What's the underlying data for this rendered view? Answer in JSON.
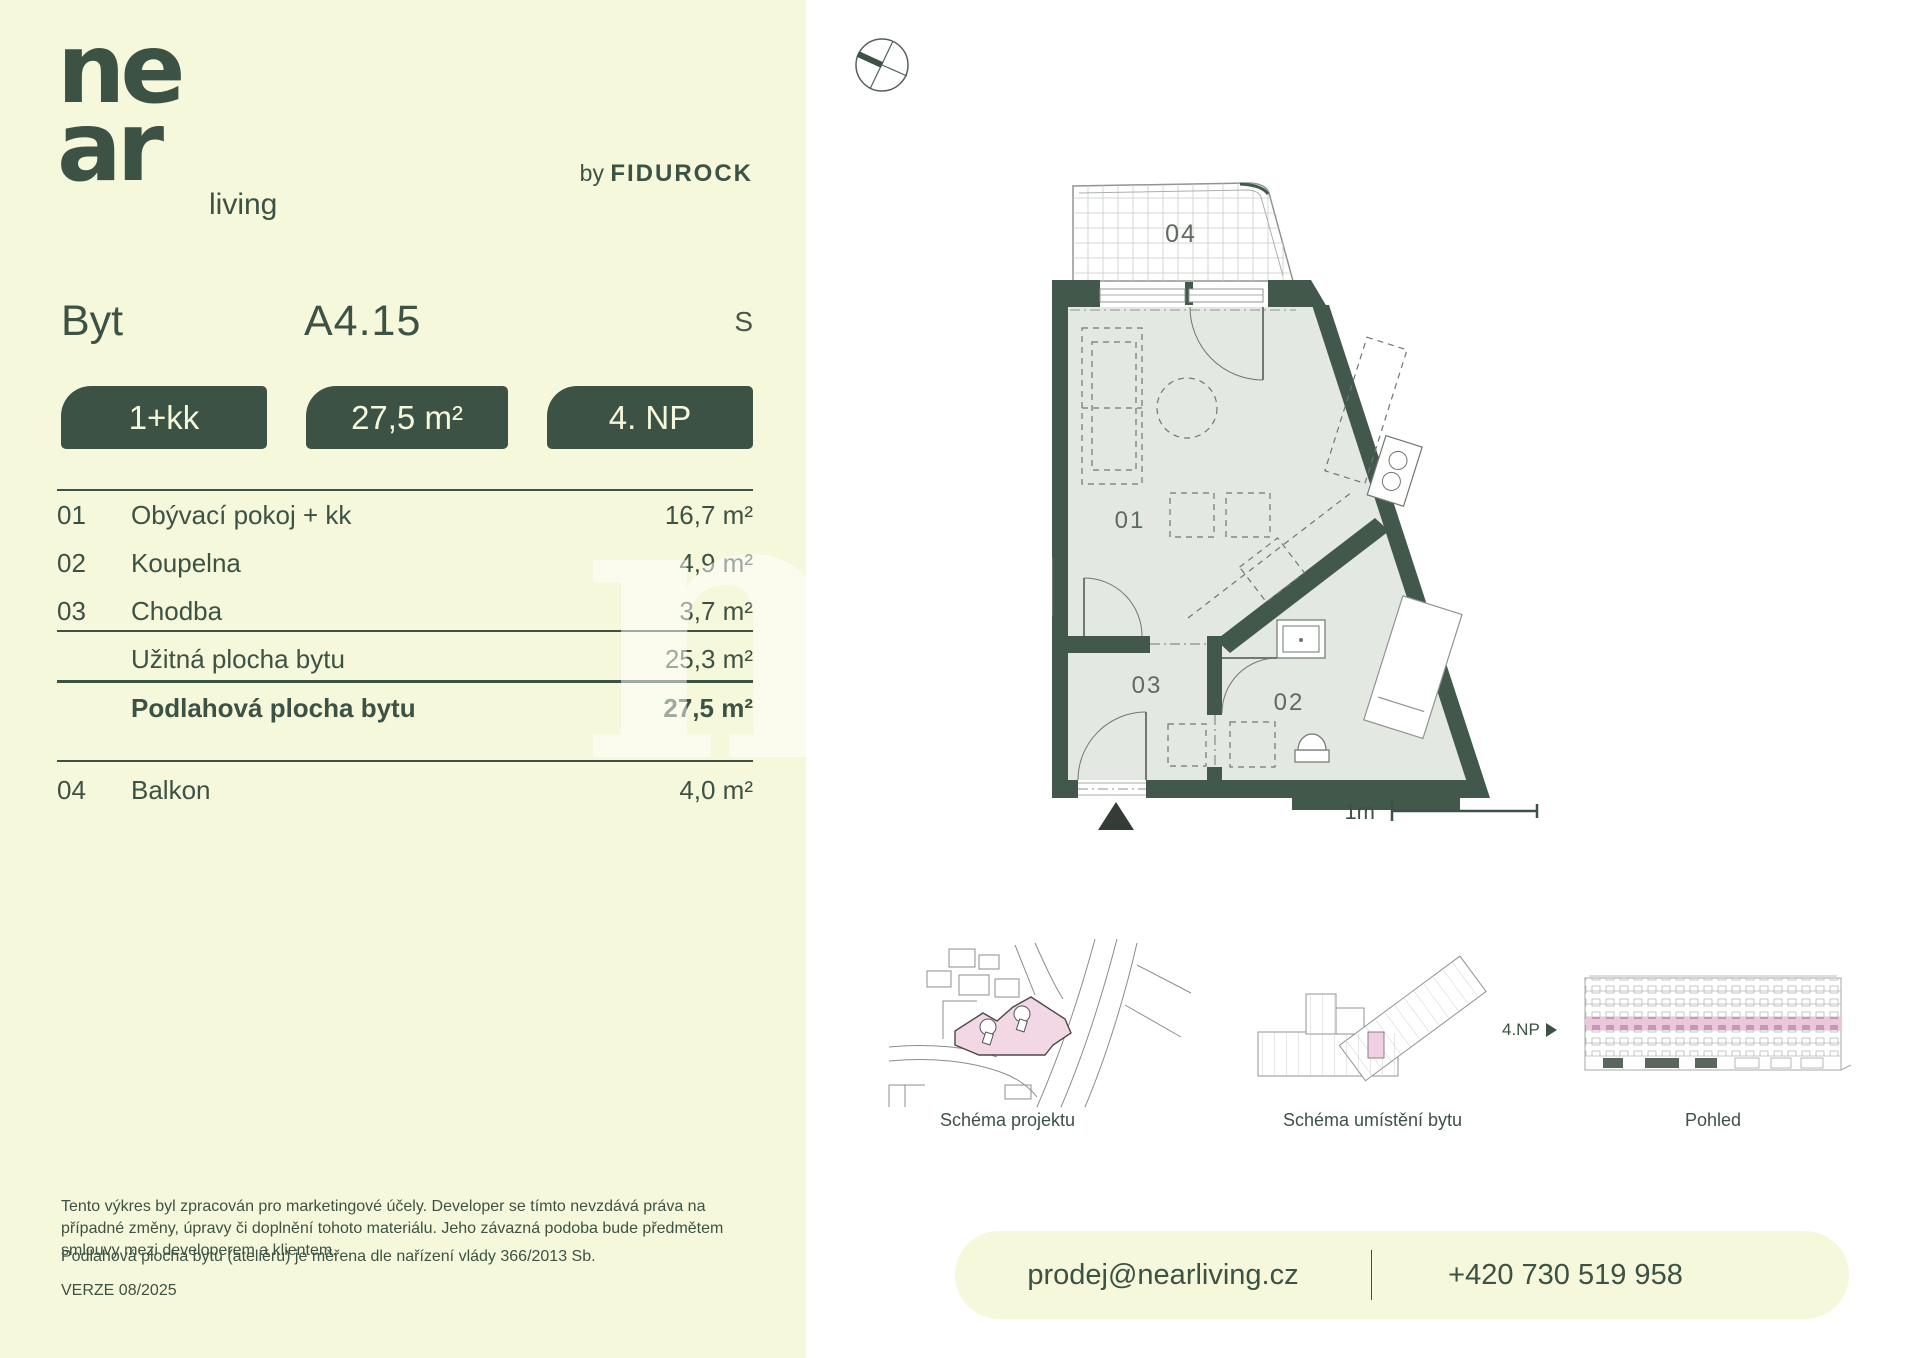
{
  "colors": {
    "cream": "#F6F8DB",
    "brand_green": "#3C5245",
    "wall_green": "#41584A",
    "floor_fill": "#E4E8E2",
    "pink_highlight": "#F2D7E5",
    "pink_strip": "#EBC7DC"
  },
  "brand": {
    "logo_top": "ne",
    "logo_bottom": "ar",
    "logo_suffix": "living",
    "by_prefix": "by ",
    "by_brand": "FIDUROCK"
  },
  "header": {
    "type_label": "Byt",
    "unit_id": "A4.15",
    "orientation": "S"
  },
  "badges": [
    {
      "label": "1+kk"
    },
    {
      "label": "27,5 m²"
    },
    {
      "label": "4. NP"
    }
  ],
  "rooms": [
    {
      "num": "01",
      "name": "Obývací pokoj + kk",
      "area": "16,7 m²"
    },
    {
      "num": "02",
      "name": "Koupelna",
      "area": "4,9 m²"
    },
    {
      "num": "03",
      "name": "Chodba",
      "area": "3,7 m²"
    }
  ],
  "summary": [
    {
      "name": "Užitná plocha bytu",
      "area": "25,3 m²"
    },
    {
      "name": "Podlahová plocha bytu",
      "area": "27,5 m²"
    }
  ],
  "extras": [
    {
      "num": "04",
      "name": "Balkon",
      "area": "4,0 m²"
    }
  ],
  "plan": {
    "labels": {
      "r01": "01",
      "r02": "02",
      "r03": "03",
      "r04": "04"
    },
    "scale": "1m"
  },
  "schematics": {
    "site_caption": "Schéma projektu",
    "location_caption": "Schéma umístění bytu",
    "elevation_caption": "Pohled",
    "floor_label": "4.NP"
  },
  "footer": {
    "disclaimer1": "Tento výkres byl zpracován pro marketingové účely. Developer se tímto nevzdává práva na případné změny, úpravy či doplnění tohoto materiálu. Jeho závazná podoba bude předmětem smlouvy mezi developerem a klientem.",
    "disclaimer2": "Podlahová plocha bytu (ateliéru) je měřena dle nařízení vlády 366/2013 Sb.",
    "version": "VERZE 08/2025"
  },
  "contact": {
    "email": "prodej@nearliving.cz",
    "phone": "+420 730 519 958"
  }
}
